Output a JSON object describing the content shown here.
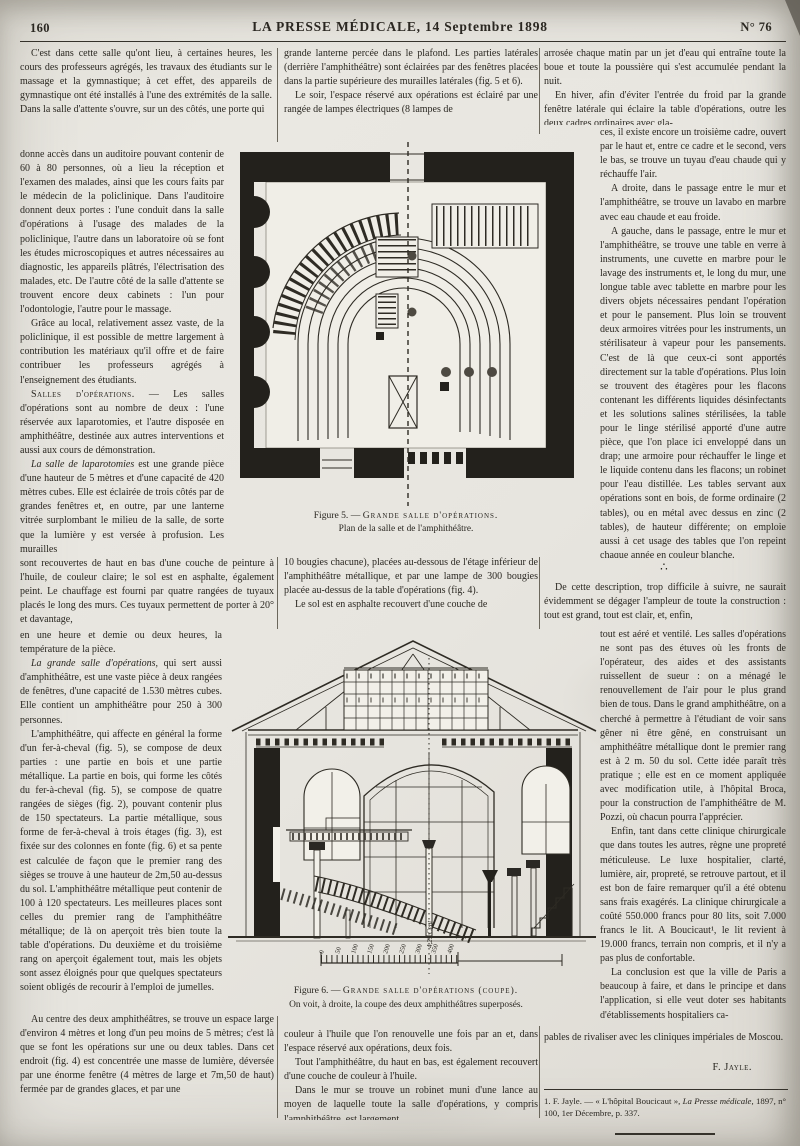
{
  "header": {
    "page_number": "160",
    "title": "LA PRESSE MÉDICALE, 14 Septembre 1898",
    "issue": "N° 76"
  },
  "left": {
    "p1": "C'est dans cette salle qu'ont lieu, à certaines heures, les cours des professeurs agrégés, les travaux des étudiants sur le massage et la gymnastique; à cet effet, des appareils de gymnastique ont été installés à l'une des extrémités de la salle. Dans la salle d'attente s'ouvre, sur un des côtés, une porte qui",
    "p2": "donne accès dans un auditoire pouvant contenir de 60 à 80 personnes, où a lieu la réception et l'examen des malades, ainsi que les cours faits par le médecin de la policlinique. Dans l'auditoire donnent deux portes : l'une conduit dans la salle d'opérations à l'usage des malades de la policlinique, l'autre dans un laboratoire où se font les études microscopiques et autres nécessaires au diagnostic, les appareils plâtrés, l'électrisation des malades, etc. De l'autre côté de la salle d'attente se trouvent encore deux cabinets : l'un pour l'odontologie, l'autre pour le massage.",
    "p3": "Grâce au local, relativement assez vaste, de la policlinique, il est possible de mettre largement à contribution les matériaux qu'il offre et de faire contribuer les professeurs agrégés à l'enseignement des étudiants.",
    "p4_lead": "Salles d'opérations.",
    "p4_rest": " — Les salles d'opérations sont au nombre de deux : l'une réservée aux laparotomies, et l'autre disposée en amphithéâtre, destinée aux autres interventions et aussi aux cours de démonstration.",
    "p5_lead": "La salle de laparotomies",
    "p5_rest": " est une grande pièce d'une hauteur de 5 mètres et d'une capacité de 420 mètres cubes. Elle est éclairée de trois côtés par de grandes fenêtres et, en outre, par une lanterne vitrée surplombant le milieu de la salle, de sorte que la lumière y est versée à profusion. Les murailles",
    "p6": "sont recouvertes de haut en bas d'une couche de peinture à l'huile, de couleur claire; le sol est en asphalte, également peint. Le chauffage est fourni par quatre rangées de tuyaux placés le long des murs. Ces tuyaux permettent de porter à 20° et davantage,",
    "p7": "en une heure et demie ou deux heures, la température de la pièce.",
    "p8_lead": "La grande salle d'opérations,",
    "p8_rest": " qui sert aussi d'amphithéâtre, est une vaste pièce à deux rangées de fenêtres, d'une capacité de 1.530 mètres cubes. Elle contient un amphithéâtre pour 250 à 300 personnes.",
    "p9": "L'amphithéâtre, qui affecte en général la forme d'un fer-à-cheval (fig. 5), se compose de deux parties : une partie en bois et une partie métallique. La partie en bois, qui forme les côtés du fer-à-cheval (fig. 5), se compose de quatre rangées de sièges (fig. 2), pouvant contenir plus de 150 spectateurs. La partie métallique, sous forme de fer-à-cheval à trois étages (fig. 3), est fixée sur des colonnes en fonte (fig. 6) et sa pente est calculée de façon que le premier rang des sièges se trouve à une hauteur de 2m,50 au-dessus du sol. L'amphithéâtre métallique peut contenir de 100 à 120 spectateurs. Les meilleures places sont celles du premier rang de l'amphithéâtre métallique; de là on aperçoit très bien toute la table d'opérations. Du deuxième et du troisième rang on aperçoit également tout, mais les objets sont assez éloignés pour que quelques spectateurs soient obligés de recourir à l'emploi de jumelles.",
    "p10": "Au centre des deux amphithéâtres, se trouve un espace large d'environ 4 mètres et long d'un peu moins de 5 mètres; c'est là que se font les opérations sur une ou deux tables. Dans cet endroit (fig. 4) est concentrée une masse de lumière, déversée par une énorme fenêtre (4 mètres de large et 7m,50 de haut) fermée par de grandes glaces, et par une"
  },
  "middle": {
    "p1": "grande lanterne percée dans le plafond. Les parties latérales (derrière l'amphithéâtre) sont éclairées par des fenêtres placées dans la partie supérieure des murailles latérales (fig. 5 et 6).",
    "p2": "Le soir, l'espace réservé aux opérations est éclairé par une rangée de lampes électriques (8 lampes de",
    "p3": "10 bougies chacune), placées au-dessous de l'étage inférieur de l'amphithéâtre métallique, et par une lampe de 300 bougies placée au-dessus de la table d'opérations (fig. 4).",
    "p4": "Le sol est en asphalte recouvert d'une couche de",
    "p5": "couleur à l'huile que l'on renouvelle une fois par an et, dans l'espace réservé aux opérations, deux fois.",
    "p6": "Tout l'amphithéâtre, du haut en bas, est également recouvert d'une couche de couleur à l'huile.",
    "p7": "Dans le mur se trouve un robinet muni d'une lance au moyen de laquelle toute la salle d'opérations, y compris l'amphithéâtre, est largement"
  },
  "right": {
    "p1": "arrosée chaque matin par un jet d'eau qui entraîne toute la boue et toute la poussière qui s'est accumulée pendant la nuit.",
    "p2": "En hiver, afin d'éviter l'entrée du froid par la grande fenêtre latérale qui éclaire la table d'opérations, outre les deux cadres ordinaires avec gla-",
    "p3": "ces, il existe encore un troisième cadre, ouvert par le haut et, entre ce cadre et le second, vers le bas, se trouve un tuyau d'eau chaude qui y réchauffe l'air.",
    "p4": "A droite, dans le passage entre le mur et l'amphithéâtre, se trouve un lavabo en marbre avec eau chaude et eau froide.",
    "p5": "A gauche, dans le passage, entre le mur et l'amphithéâtre, se trouve une table en verre à instruments, une cuvette en marbre pour le lavage des instruments et, le long du mur, une longue table avec tablette en marbre pour les divers objets nécessaires pendant l'opération et pour le pansement. Plus loin se trouvent deux armoires vitrées pour les instruments, un stérilisateur à vapeur pour les pansements. C'est de là que ceux-ci sont apportés directement sur la table d'opérations. Plus loin se trouvent des étagères pour les flacons contenant les différents liquides désinfectants et les solutions salines stérilisées, la table pour le linge stérilisé apporté d'une autre pièce, que l'on place ici enveloppé dans un drap; une armoire pour réchauffer le linge et le liquide contenu dans les flacons; un robinet pour l'eau distillée. Les tables servant aux opérations sont en bois, de forme ordinaire (2 tables), ou en métal avec dessus en zinc (2 tables), de hauteur différente; on emploie aussi à cet usage des tables que l'on repeint chaque année en couleur blanche.",
    "separator": "∴",
    "p6": "De cette description, trop difficile à suivre, ne saurait évidemment se dégager l'ampleur de toute la construction : tout est grand, tout est clair, et, enfin,",
    "p7": "tout est aéré et ventilé. Les salles d'opérations ne sont pas des étuves où les fronts de l'opérateur, des aides et des assistants ruissellent de sueur : on a ménagé le renouvellement de l'air pour le plus grand bien de tous. Dans le grand amphithéâtre, on a cherché à permettre à l'étudiant de voir sans gêner ni être gêné, en construisant un amphithéâtre métallique dont le premier rang est à 2 m. 50 du sol. Cette idée paraît très pratique ; elle est en ce moment appliquée avec modification utile, à l'hôpital Broca, pour la construction de l'amphithéâtre de M. Pozzi, où chacun pourra l'apprécier.",
    "p8": "Enfin, tant dans cette clinique chirurgicale que dans toutes les autres, règne une propreté méticuleuse. Le luxe hospitalier, clarté, lumière, air, propreté, se retrouve partout, et il est bon de faire remarquer qu'il a été obtenu sans frais exagérés. La clinique chirurgicale a coûté 550.000 francs pour 80 lits, soit 7.000 francs le lit. A Boucicaut¹, le lit revient à 19.000 francs, terrain non compris, et il n'y a pas plus de confortable.",
    "p9": "La conclusion est que la ville de Paris a beaucoup à faire, et dans le principe et dans l'application, si elle veut doter ses habitants d'établissements hospitaliers ca-",
    "p10": "pables de rivaliser avec les cliniques impériales de Moscou.",
    "signature": "F. Jayle.",
    "footnote_1": "1. F. Jayle. — « L'hôpital Boucicaut », ",
    "footnote_2": "La Presse médicale",
    "footnote_3": ", 1897, n° 100, 1er Décembre, p. 337."
  },
  "figure5": {
    "caption_1a": "Figure 5. — ",
    "caption_1b": "Grande salle d'opérations.",
    "caption_2": "Plan de la salle et de l'amphithéâtre."
  },
  "figure6": {
    "caption_1a": "Figure 6. — ",
    "caption_1b": "Grande salle d'opérations (coupe).",
    "caption_2": "On voit, à droite, la coupe des deux amphithéâtres superposés.",
    "scale_label": "4,25 Cent",
    "scale": [
      "0",
      "50",
      "100",
      "150",
      "200",
      "250",
      "300",
      "350",
      "400"
    ]
  }
}
